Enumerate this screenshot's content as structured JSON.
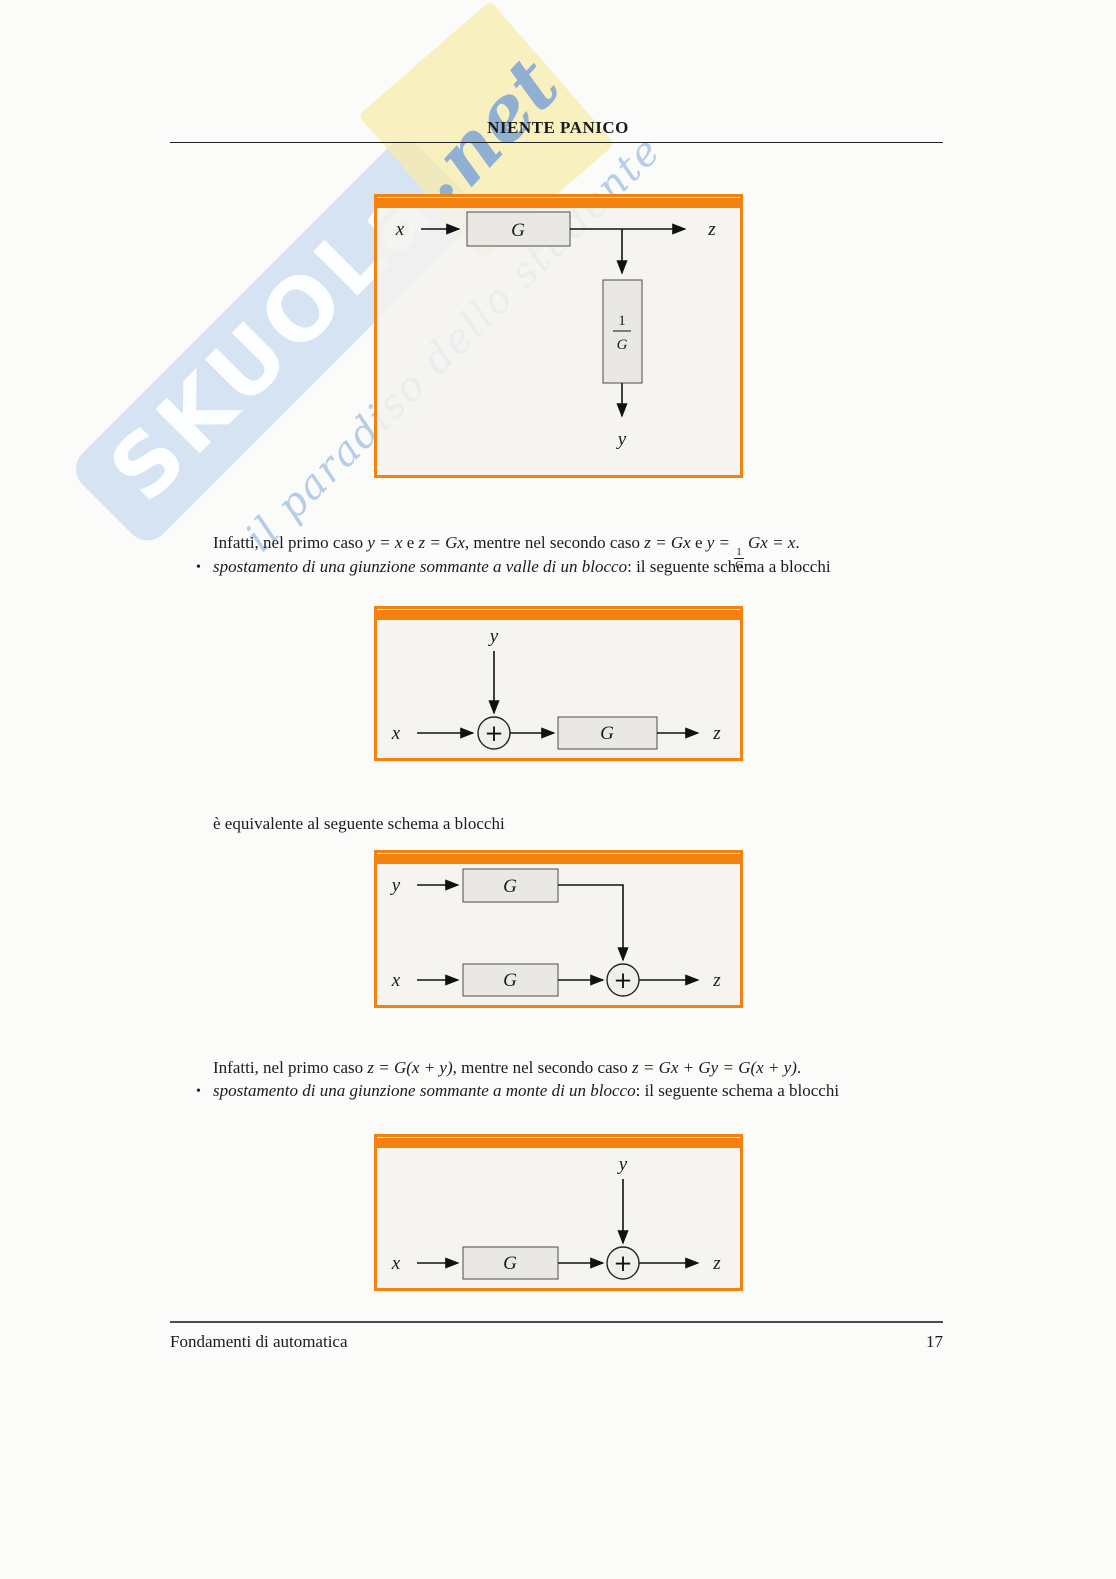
{
  "page": {
    "title": "NIENTE PANICO",
    "footer_left": "Fondamenti di automatica",
    "page_number": "17"
  },
  "watermark": {
    "brand": "SKUOLa",
    "dot": ".",
    "tld": "net",
    "tagline": "il paradiso dello studente"
  },
  "colors": {
    "accent_orange": "#f5820f",
    "figure_background": "#f3f2ef",
    "block_fill": "#e9e8e5",
    "watermark_blue": "#b2ccе9",
    "watermark_yellow": "#f8eba7"
  },
  "intro1": {
    "t1": "Infatti, nel primo caso ",
    "m1": "y = x",
    "t2": " e ",
    "m2": "z = Gx",
    "t3": ", mentre nel secondo caso ",
    "m3": "z = Gx",
    "t4": " e ",
    "m4a": "y =",
    "frac_num": "1",
    "frac_den": "G",
    "m4b": "Gx = x",
    "t5": "."
  },
  "bullet1": {
    "marker": "•",
    "italic": "spostamento di una giunzione sommante a valle di un blocco",
    "rest": ": il seguente schema a blocchi"
  },
  "equiv_text": "è equivalente al seguente schema a blocchi",
  "intro2": {
    "t1": "Infatti, nel primo caso ",
    "m1": "z = G(x + y)",
    "t2": ", mentre nel secondo caso ",
    "m2": "z = Gx + Gy = G(x + y)",
    "t3": "."
  },
  "bullet2": {
    "marker": "•",
    "italic": "spostamento di una giunzione sommante a monte di un blocco",
    "rest": ": il seguente schema a blocchi"
  },
  "diagram1": {
    "input": "x",
    "block": "G",
    "output": "z",
    "frac_num": "1",
    "frac_den": "G",
    "branch_output": "y"
  },
  "diagram2": {
    "top_input": "y",
    "input": "x",
    "sum": "+",
    "block": "G",
    "output": "z"
  },
  "diagram3": {
    "row1_input": "y",
    "row1_block": "G",
    "row2_input": "x",
    "row2_block": "G",
    "sum": "+",
    "output": "z"
  },
  "diagram4": {
    "top_input": "y",
    "input": "x",
    "block": "G",
    "sum": "+",
    "output": "z"
  }
}
